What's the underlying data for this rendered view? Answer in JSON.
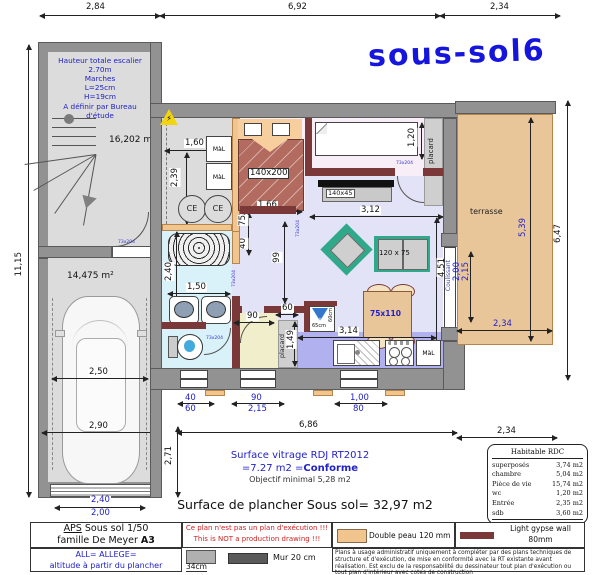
{
  "title": "sous-sol6",
  "stair_note": [
    "Hauteur totale escalier 2.70m",
    "Marches",
    "L=25cm",
    "H=19cm",
    "A définir par Bureau d'étude"
  ],
  "areas": {
    "stairwell": "16,202 m²",
    "garage": "14,475 m²"
  },
  "rooms": {
    "terrasse": "terrasse",
    "placard": "placard",
    "coulissant": "Coulissant"
  },
  "furniture": {
    "double_bed": "140x200",
    "desk": "140x45",
    "sofa": "120 x 75",
    "table": "75x110",
    "washer": "MàL",
    "water_heater": "CE",
    "fridge_width": "65cm",
    "fridge_depth": "60cm"
  },
  "door_size": "73x204",
  "icons": {
    "warning": "⚡",
    "snowflake": "❄"
  },
  "colors": {
    "annotation_blue": "#2121c8",
    "wall_gray": "#929292",
    "gypse_red": "#7a3838",
    "peau_tan": "#f2c48e",
    "terrace_tan": "#e9c69a"
  },
  "dims": {
    "top_left": "2,84",
    "top_mid": "6,92",
    "top_right": "2,34",
    "left_total": "11,15",
    "right_total": "6,47",
    "tech_width": "1,60",
    "tech_height": "2,39",
    "bed_width": "1,66",
    "bed_gap": "75",
    "wall_gap": "40",
    "room2_width": "3,12",
    "single_bed": "1,20",
    "living_height": "4,51",
    "living_width": "3,14",
    "hall": "99",
    "bath_height": "2,40",
    "bath_width": "1,50",
    "entry_door": "90",
    "placard_width": "60",
    "placard_depth": "1,49",
    "garage_inner": "2,50",
    "garage_outer": "2,90",
    "facade": "6,86",
    "facade_side": "2,71",
    "terrace_len": "5,39",
    "terrace_width": "2,34",
    "terrace_a": "2,00",
    "terrace_b": "2,15",
    "win1_a": "40",
    "win1_b": "60",
    "win2_a": "90",
    "win2_b": "2,15",
    "win3_a": "1,00",
    "win3_b": "80",
    "gdoor_a": "2,40",
    "gdoor_b": "2,00",
    "rdc": "2,34"
  },
  "notes": {
    "vitrage1": "Surface vitrage RDJ RT2012",
    "vitrage2a": "=7.27 m2 =",
    "vitrage2b": "Conforme",
    "vitrage3": "Objectif minimal 5,28 m2",
    "surface": "Surface de plancher Sous sol= 32,97 m2"
  },
  "rdc_table": {
    "title": "Habitable RDC",
    "rows": [
      [
        "superposés",
        "3,74 m2"
      ],
      [
        "chambre",
        "5,04 m2"
      ],
      [
        "Pièce de vie",
        "15,74 m2"
      ],
      [
        "wc",
        "1,20 m2"
      ],
      [
        "Entrée",
        "2,35 m2"
      ],
      [
        "sdb",
        "3,60 m2"
      ]
    ],
    "total_label": "Total rdc",
    "total_value": "31,67 m2"
  },
  "legend": {
    "aps": "APS",
    "aps_rest": "  Sous sol 1/50",
    "family": "famille De Meyer ",
    "family_b": "A3",
    "warn1": "Ce plan n'est pas un plan d'exécution !!!",
    "warn2": "This is NOT a production drawing !!!",
    "all1": "ALL= ALLEGE=",
    "all2": "altitude à partir du plancher",
    "allege_h": "34cm",
    "mur": "Mur 20 cm",
    "peau": "Double peau 120 mm",
    "gypse1": "Light gypse wall 80mm",
    "gypse2": "Ba13 80 mm",
    "disclaimer": "Plans à usage administratif uniquement à compléter par des plans techniques de structure et d'exécution, de mise en conformité avec la RT existante avant réalisation. Est exclu de la responsabilité du dessinateur tout plan d'exécution ou tout plan d'intérieur avec cotes de construction"
  }
}
